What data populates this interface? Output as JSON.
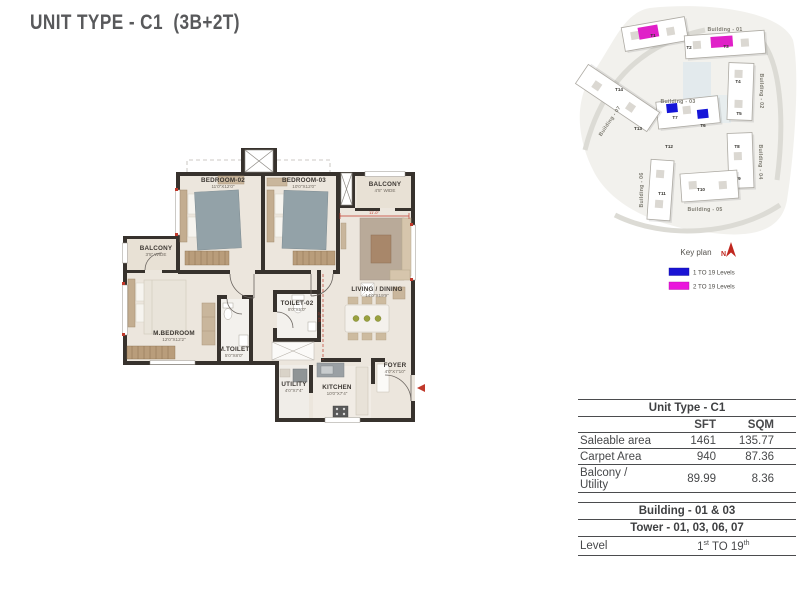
{
  "page": {
    "title": "UNIT TYPE - C1  (3B+2T)"
  },
  "floor_plan": {
    "rooms": {
      "bedroom02": {
        "name": "BEDROOM-02",
        "dims": "11'0\"X12'0\""
      },
      "bedroom03": {
        "name": "BEDROOM-03",
        "dims": "10'0\"X12'0\""
      },
      "balcony_top": {
        "name": "BALCONY",
        "dims": "4'5\" WIDE"
      },
      "balcony_left": {
        "name": "BALCONY",
        "dims": "3'5\" WIDE"
      },
      "master_bedroom": {
        "name": "M.BEDROOM",
        "dims": "12'0\"X12'2\""
      },
      "master_toilet": {
        "name": "M.TOILET",
        "dims": "5'0\"X8'0\""
      },
      "toilet02": {
        "name": "TOILET-02",
        "dims": "8'0\"X5'0\""
      },
      "living_dining": {
        "name": "LIVING / DINING",
        "dims": "14'0\"X19'9\""
      },
      "utility": {
        "name": "UTILITY",
        "dims": "4'0\"X7'4\""
      },
      "kitchen": {
        "name": "KITCHEN",
        "dims": "10'0\"X7'4\""
      },
      "foyer": {
        "name": "FOYER",
        "dims": "4'0\"X7'10\""
      }
    },
    "dimensions": {
      "living_width": "11'-0\"",
      "living_height": "12'-2\""
    }
  },
  "key_plan": {
    "title": "Key plan",
    "north_label": "N",
    "buildings": [
      {
        "label": "Building - 01"
      },
      {
        "label": "Building - 02"
      },
      {
        "label": "Building - 03"
      },
      {
        "label": "Building - 04"
      },
      {
        "label": "Building - 05"
      },
      {
        "label": "Building - 06"
      },
      {
        "label": "Building - 07"
      }
    ],
    "towers": [
      "T1",
      "T2",
      "T3",
      "T4",
      "T5",
      "T6",
      "T7",
      "T8",
      "T9",
      "T10",
      "T11",
      "T12",
      "T13",
      "T14"
    ],
    "legend": [
      {
        "color": "#1a13d4",
        "label": "1 TO 19 Levels"
      },
      {
        "color": "#ea16dc",
        "label": "2 TO 19 Levels"
      }
    ]
  },
  "info_table": {
    "title": "Unit Type - C1",
    "col_sft": "SFT",
    "col_sqm": "SQM",
    "rows": [
      {
        "label": "Saleable area",
        "sft": "1461",
        "sqm": "135.77"
      },
      {
        "label": "Carpet Area",
        "sft": "940",
        "sqm": "87.36"
      },
      {
        "label": "Balcony / Utility",
        "sft": "89.99",
        "sqm": "8.36"
      }
    ],
    "building": "Building - 01 & 03",
    "tower": "Tower - 01, 03, 06, 07",
    "level_label": "Level",
    "level_value": {
      "n1": "1",
      "s1": "st",
      "mid": " TO 19",
      "s2": "th"
    }
  },
  "colors": {
    "accent_blue": "#1a13d4",
    "accent_magenta": "#ea16dc",
    "wall": "#37322d",
    "red": "#c0392b"
  }
}
